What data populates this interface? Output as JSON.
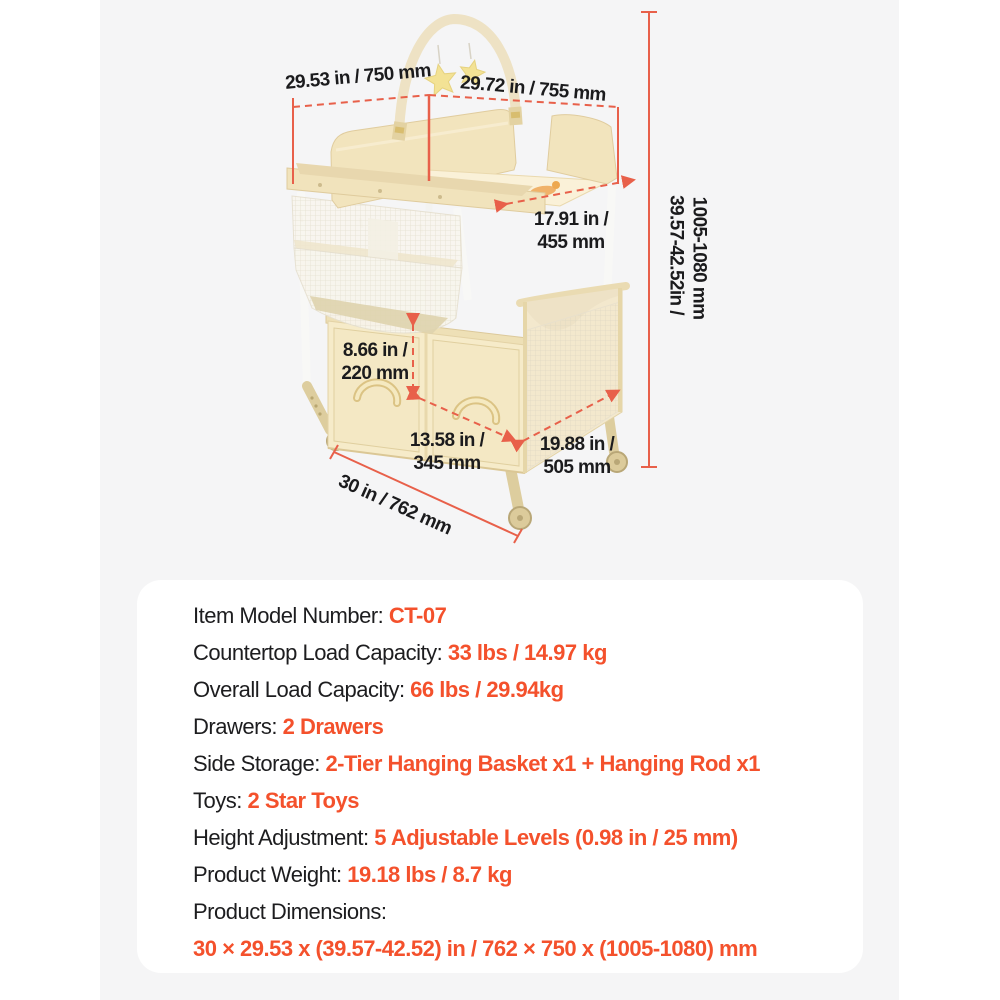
{
  "colors": {
    "accent_text": "#f4512c",
    "dimension_line": "#e8604a",
    "panel_background": "#f5f5f6",
    "card_background": "#ffffff",
    "product_cream": "#f3e6c1"
  },
  "product": {
    "name": "Baby changing table with arch toy bar, 2-tier hanging basket, drawers and wheels"
  },
  "annotations": {
    "top_width": "29.53 in / 750 mm",
    "top_depth": "29.72 in / 755 mm",
    "tabletop_depth": "17.91 in /\n455 mm",
    "height_range_in": "39.57-42.52in /",
    "height_range_mm": "1005-1080 mm",
    "basket_height": "8.66 in /\n220 mm",
    "drawer_width": "13.58 in /\n345 mm",
    "base_depth": "19.88 in /\n505 mm",
    "base_width": "30 in / 762 mm"
  },
  "specs": {
    "rows": [
      {
        "label": "Item Model Number: ",
        "value": "CT-07"
      },
      {
        "label": "Countertop Load Capacity: ",
        "value": "33 lbs / 14.97 kg"
      },
      {
        "label": "Overall Load Capacity: ",
        "value": "66 lbs / 29.94kg"
      },
      {
        "label": "Drawers: ",
        "value": "2 Drawers"
      },
      {
        "label": "Side Storage: ",
        "value": "2-Tier Hanging Basket x1 + Hanging Rod x1"
      },
      {
        "label": "Toys: ",
        "value": "2 Star Toys"
      },
      {
        "label": "Height Adjustment: ",
        "value": "5 Adjustable Levels (0.98 in / 25 mm)"
      },
      {
        "label": "Product Weight: ",
        "value": "19.18 lbs / 8.7 kg"
      },
      {
        "label": "Product Dimensions:",
        "value": ""
      },
      {
        "label": "",
        "value": "30 × 29.53 x (39.57-42.52) in / 762 × 750 x (1005-1080) mm"
      }
    ]
  }
}
